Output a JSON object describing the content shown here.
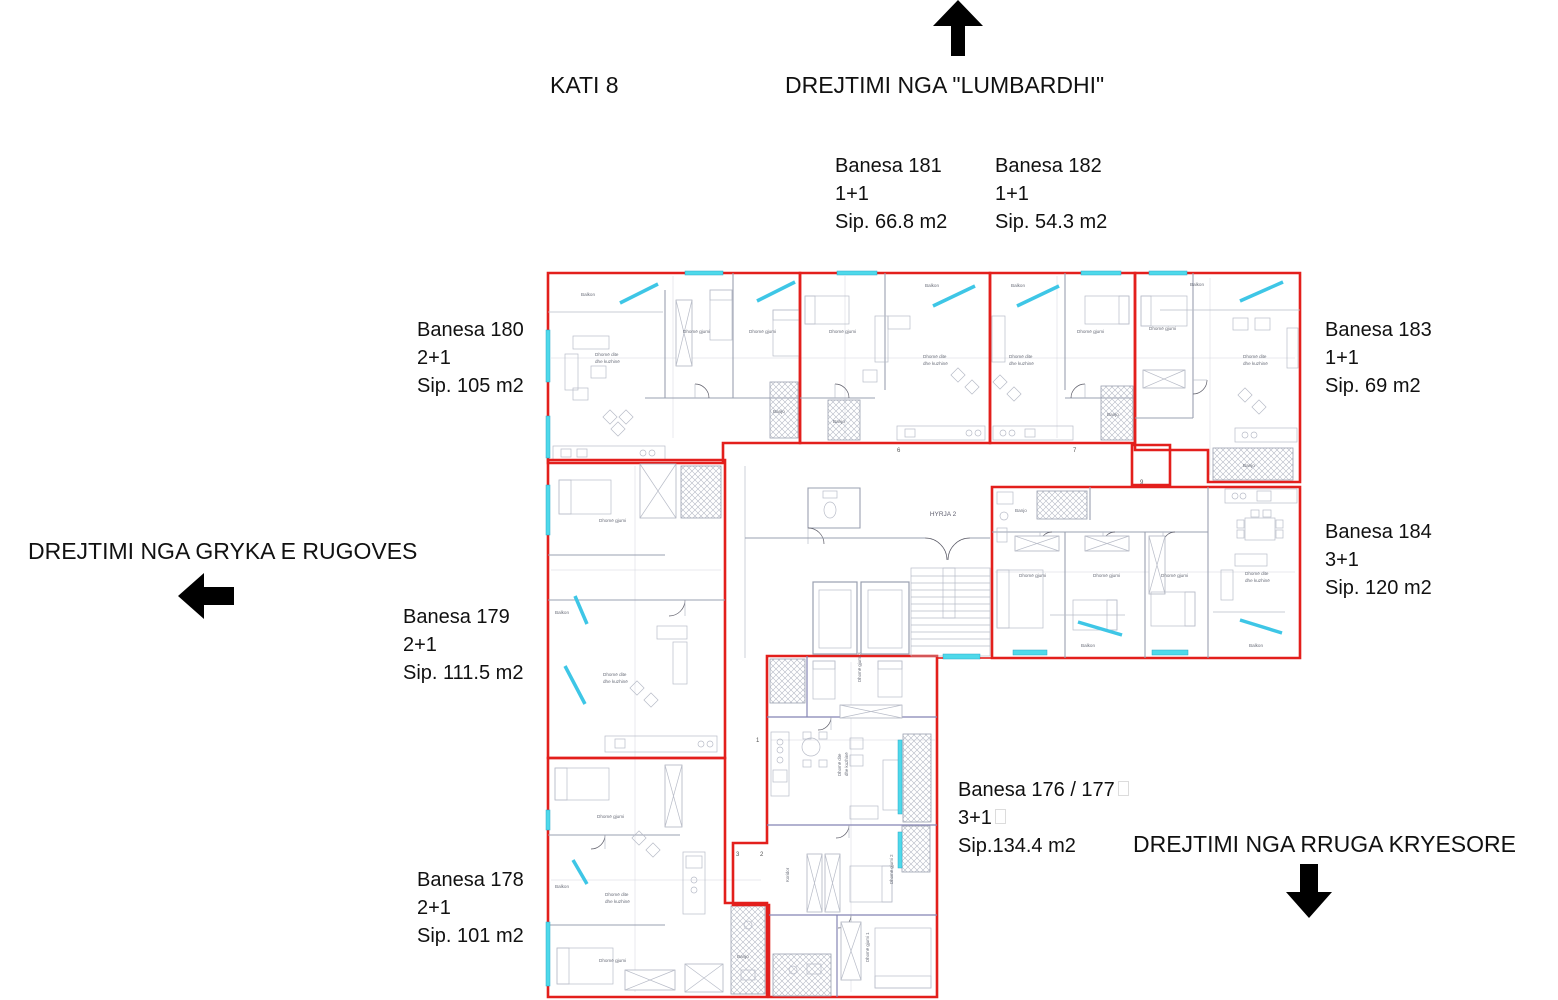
{
  "floor_label": "KATI 8",
  "directions": {
    "top": "DREJTIMI NGA \"LUMBARDHI\"",
    "left": "DREJTIMI NGA GRYKA E RUGOVES",
    "bottom": "DREJTIMI NGA RRUGA KRYESORE"
  },
  "apartments": [
    {
      "name": "Banesa 180",
      "type": "2+1",
      "area": "Sip. 105 m2"
    },
    {
      "name": "Banesa 181",
      "type": "1+1",
      "area": "Sip. 66.8 m2"
    },
    {
      "name": "Banesa 182",
      "type": "1+1",
      "area": "Sip. 54.3 m2"
    },
    {
      "name": "Banesa 183",
      "type": "1+1",
      "area": "Sip. 69 m2"
    },
    {
      "name": "Banesa 184",
      "type": "3+1",
      "area": "Sip. 120 m2"
    },
    {
      "name": "Banesa 179",
      "type": "2+1",
      "area": "Sip. 111.5 m2"
    },
    {
      "name": "Banesa 178",
      "type": "2+1",
      "area": "Sip. 101 m2"
    },
    {
      "name": "Banesa 176 / 177",
      "type": "3+1",
      "area": "Sip.134.4 m2"
    }
  ],
  "plan": {
    "entry_label": "HYRJA 2",
    "room_labels": {
      "balkon": "Balkon",
      "bedroom": "Dhomë gjumi",
      "bedroom1": "Dhomë gjumi 1",
      "bedroom2": "Dhomë gjumi 2",
      "bedroom3": "Dhomë gjumi 3",
      "living1": "Dhomë dite",
      "living2": "dhe kuzhinë",
      "bath": "Banjo",
      "corridor": "Koridor"
    },
    "axis_numbers": [
      "6",
      "7",
      "9",
      "1",
      "2",
      "3"
    ],
    "colors": {
      "outline": "#e31f1c",
      "window": "#3ec6e6",
      "wall": "#9aa0b0",
      "accent_wall": "#8585b5"
    }
  }
}
